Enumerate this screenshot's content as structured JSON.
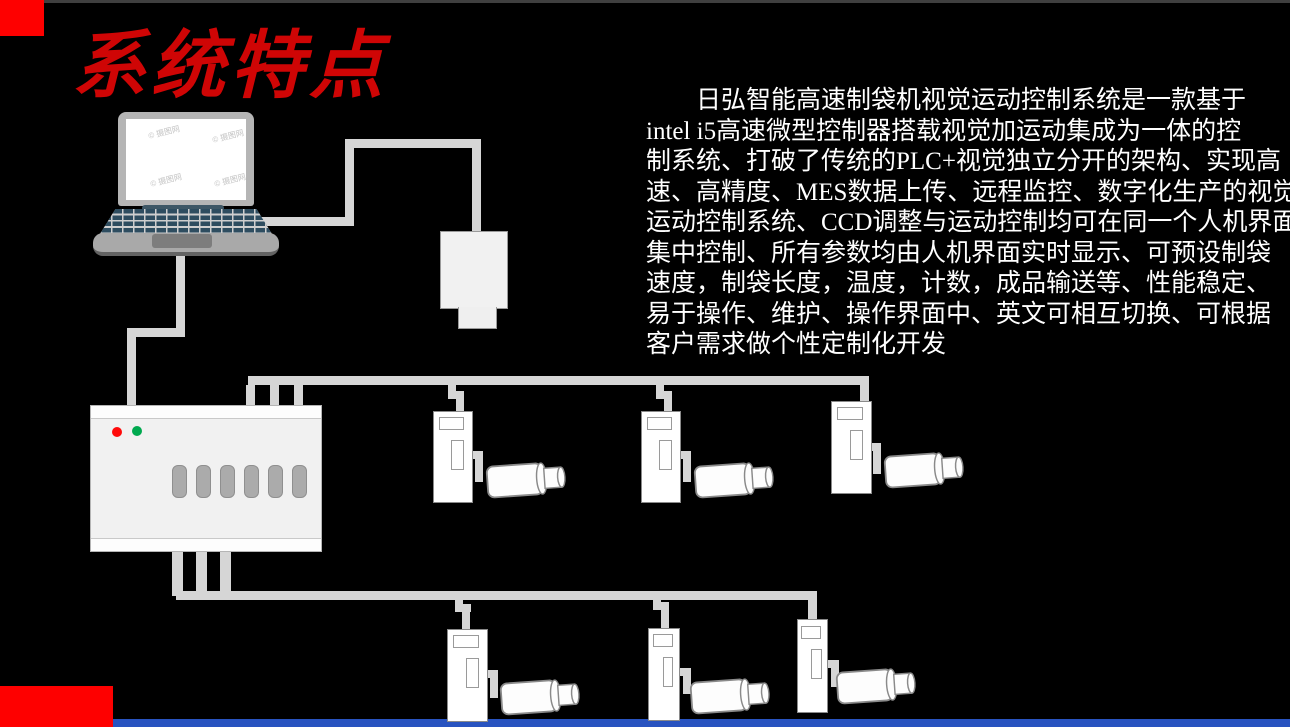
{
  "slide": {
    "title": "系统特点",
    "watermark": "© 摄图网",
    "paragraph_lines": [
      "　　日弘智能高速制袋机视觉运动控制系统是一款基于",
      "intel i5高速微型控制器搭载视觉加运动集成为一体的控",
      "制系统、打破了传统的PLC+视觉独立分开的架构、实现高",
      "速、高精度、MES数据上传、远程监控、数字化生产的视觉",
      "运动控制系统、CCD调整与运动控制均可在同一个人机界面",
      "集中控制、所有参数均由人机界面实时显示、可预设制袋",
      "速度，制袋长度，温度，计数，成品输送等、性能稳定、",
      "易于操作、维护、操作界面中、英文可相互切换、可根据",
      "客户需求做个性定制化开发"
    ],
    "colors": {
      "background": "#000000",
      "title_red": "#cf0505",
      "accent_red": "#fe0000",
      "footer_blue": "#2853c0",
      "cable_gray": "#d6d6d6",
      "led_red": "#ff0a0a",
      "led_green": "#00a94f"
    }
  }
}
